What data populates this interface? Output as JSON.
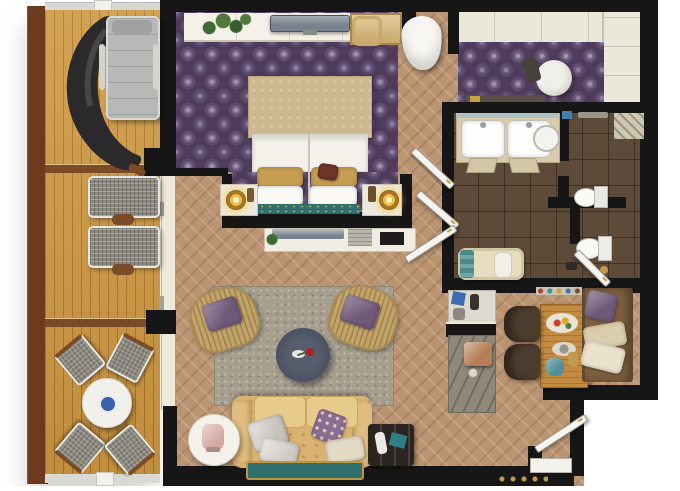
{
  "scene": {
    "title": "Hotel suite floor plan - top-down 3D render",
    "view": "top-down",
    "background": "#ffffff"
  },
  "palette": {
    "wall": "#161616",
    "deck_wood": "#CE9840",
    "deck_trim": "#6D3A1E",
    "deck_rail": "#D9D9D4",
    "carpet_purple": "#4F3C5C",
    "carpet_motif": "#A393B8",
    "wood_floor": "#BB9472",
    "bath_tile": "#5D4A39",
    "wardrobe_cream": "#EAE7DB",
    "rug_gray": "#A79F8E",
    "sofa_tan": "#D9B170",
    "cushion_tan": "#E8CA8C",
    "accent_teal": "#2F6F6E",
    "accent_gold": "#C39C4B",
    "pillow_purple": "#6F5878",
    "fixture_white": "#F6F4EE",
    "counter_stone": "#8E897B",
    "table_wood": "#C28B41",
    "bench_wood": "#7D5F40",
    "chair_dark": "#4C3C2D",
    "tv_gray": "#76828E",
    "lounger_gray": "#B6B9B6",
    "hanging_chair_black": "#2B292B",
    "bowl_blue": "#3A62AE",
    "bed_canopy": "#CDB88F",
    "bed_linen": "#F3F1EA"
  },
  "rooms": [
    {
      "id": "terrace",
      "name": "terrace-deck",
      "furniture": [
        "hanging-chair",
        "sun-lounger",
        "lounge-chair",
        "lounge-chair",
        "deck-side-table",
        "deck-side-table",
        "round-table",
        "blue-bowl",
        "woven-chair",
        "woven-chair",
        "woven-chair",
        "woven-chair"
      ]
    },
    {
      "id": "bedroom",
      "name": "bedroom",
      "furniture": [
        "wall-console",
        "plant",
        "wall-tv",
        "vanity-desk",
        "vanity-chair",
        "tub-chair",
        "double-bed",
        "bed-canopy",
        "gold-pillows",
        "white-pillows",
        "bed-runner",
        "nightstand",
        "bedside-lamp",
        "nightstand",
        "bedside-lamp"
      ]
    },
    {
      "id": "dressing",
      "name": "walk-in-closet",
      "furniture": [
        "wardrobe-top",
        "wardrobe-right",
        "round-pouf",
        "low-bench"
      ]
    },
    {
      "id": "bathroom",
      "name": "bathroom",
      "furniture": [
        "double-vanity",
        "sink",
        "sink",
        "vessel-bowl",
        "vanity-stool",
        "vanity-stool",
        "toilet",
        "bidet",
        "bathtub",
        "teal-towels",
        "white-towel",
        "shower-screen"
      ]
    },
    {
      "id": "living",
      "name": "living-room",
      "furniture": [
        "media-console",
        "console-tv",
        "area-rug",
        "rattan-armchair",
        "rattan-armchair",
        "coffee-table",
        "rose",
        "sofa",
        "silver-pillows",
        "purple-pillow",
        "cream-pillow",
        "foot-bench",
        "side-table",
        "table-lamp",
        "luggage-bench"
      ]
    },
    {
      "id": "kitchen",
      "name": "kitchenette-dining",
      "furniture": [
        "minibar",
        "bar-shelf",
        "stone-counter",
        "coffee-machine",
        "spice-shelf",
        "dining-table",
        "breakfast-plate",
        "fish-plate",
        "teal-teapot",
        "dining-chair",
        "dining-chair",
        "bench-seat",
        "bench-purple-pillow",
        "bench-cream-pillows"
      ]
    },
    {
      "id": "entry",
      "name": "entry-hall",
      "furniture": [
        "entry-door",
        "threshold"
      ]
    }
  ],
  "doors": [
    "bedroom-hall-door",
    "hall-double-door-upper",
    "hall-double-door-lower",
    "wc-door",
    "entry-door"
  ],
  "windows": [
    "terrace-railing",
    "glass-sliding-wall"
  ]
}
